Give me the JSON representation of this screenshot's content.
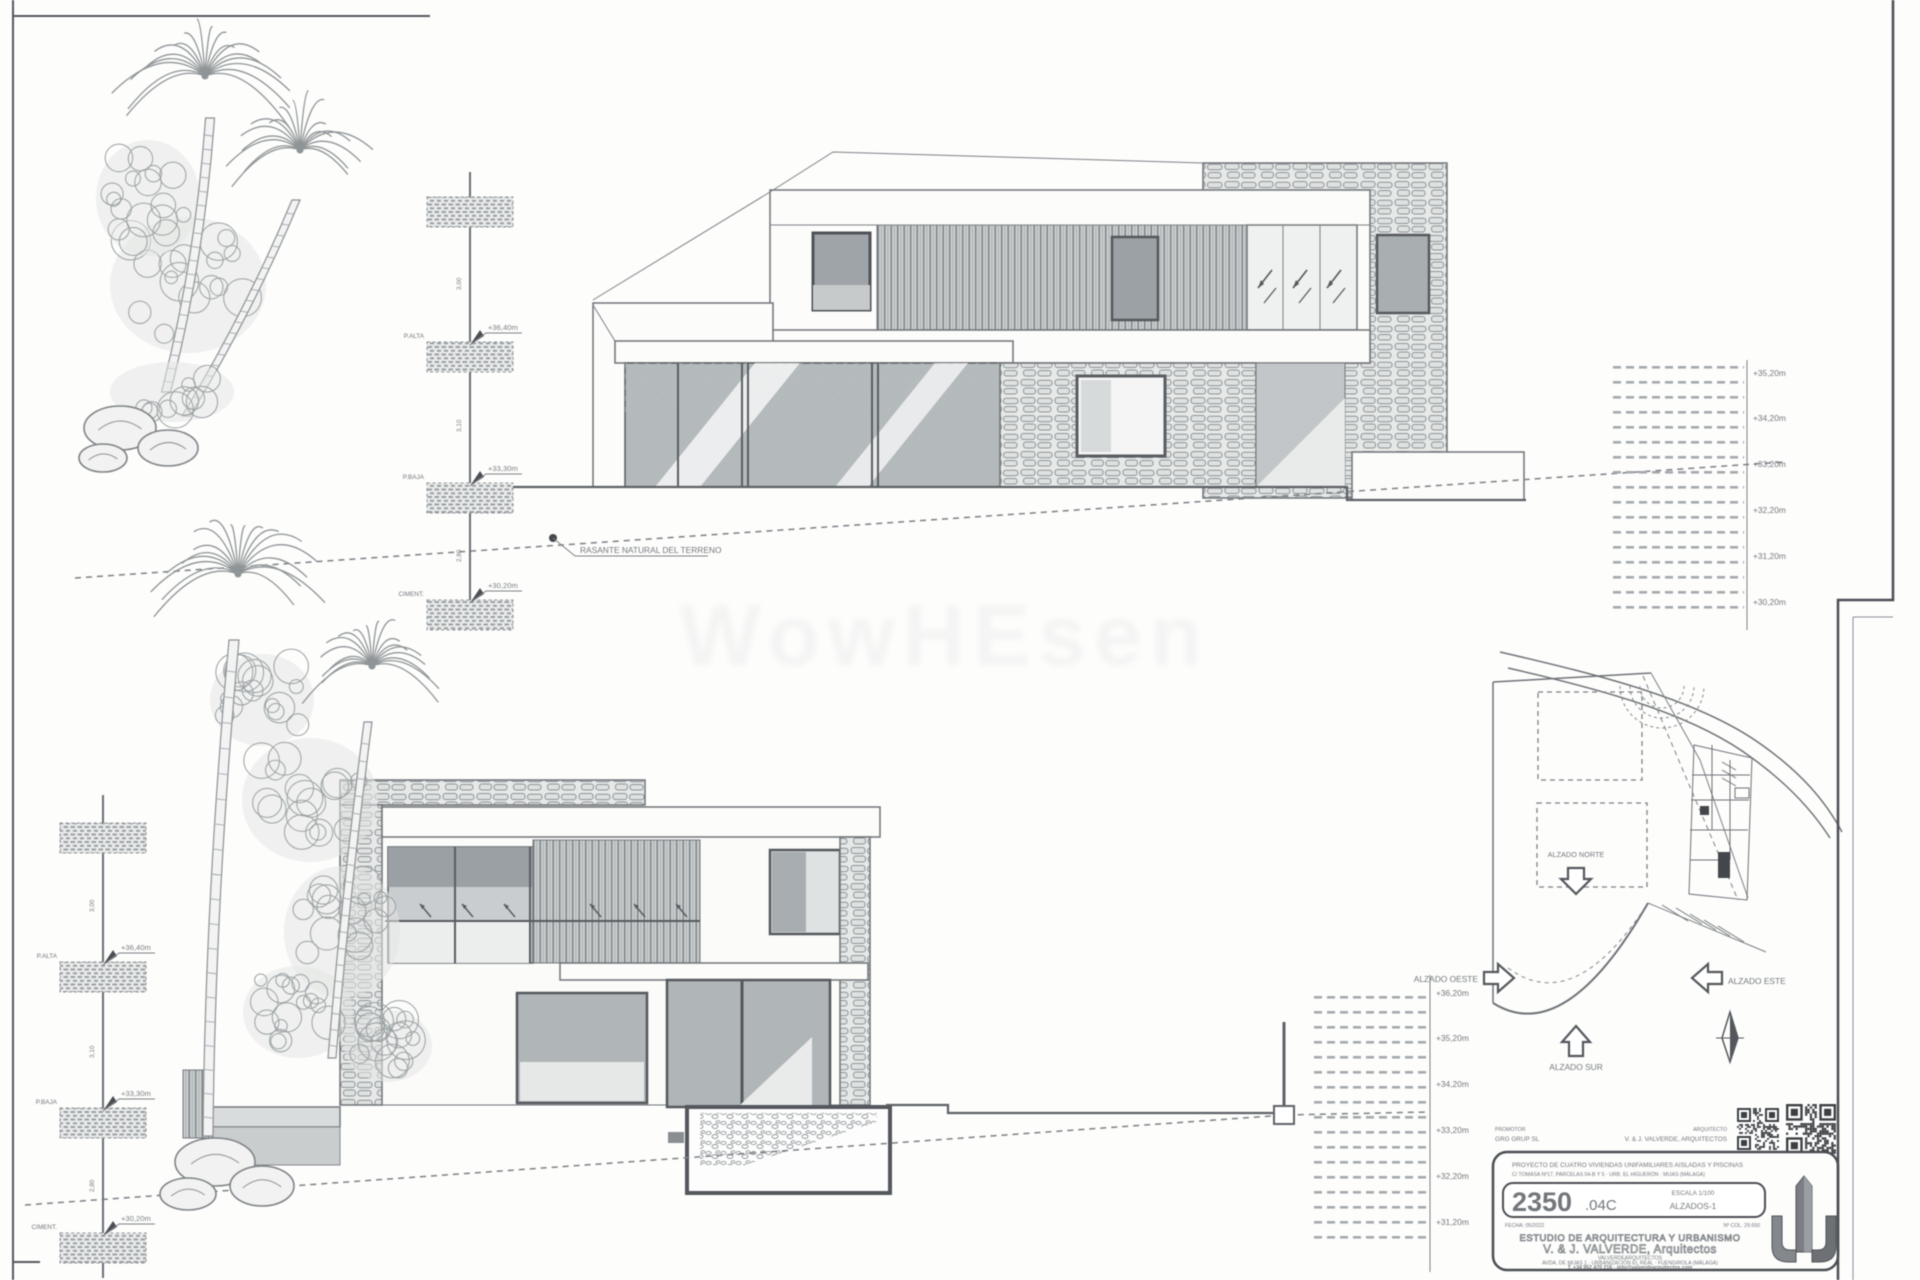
{
  "sheet": {
    "watermark": "WowHEsen"
  },
  "labels": {
    "terrain": "RASANTE NATURAL DEL TERRENO",
    "alzado_norte": "ALZADO NORTE",
    "alzado_sur": "ALZADO SUR",
    "alzado_oeste": "ALZADO OESTE",
    "alzado_este": "ALZADO ESTE"
  },
  "levels": {
    "alta": {
      "name": "P.ALTA",
      "elev": "+36,40m"
    },
    "baja": {
      "name": "P.BAJA",
      "elev": "+33,30m"
    },
    "cimentacion": {
      "name": "CIMENT.",
      "elev": "+30,20m"
    },
    "dims": [
      "3,00",
      "3,10",
      "2,80"
    ]
  },
  "ruler_top": [
    "+35,20m",
    "+34,20m",
    "+33,20m",
    "+32,20m",
    "+31,20m",
    "+30,20m"
  ],
  "ruler_bottom": [
    "+36,20m",
    "+35,20m",
    "+34,20m",
    "+33,20m",
    "+32,20m",
    "+31,20m"
  ],
  "title_block": {
    "promoter_label": "PROMOTOR",
    "promoter": "GRG GRUP SL",
    "architect_label": "ARQUITECTO",
    "architect": "V. & J. VALVERDE, ARQUITECTOS",
    "project_line1": "PROYECTO DE CUATRO VIVIENDAS UNIFAMILIARES AISLADAS Y PISCINAS",
    "project_line2": "C/ TOMASA Nº17, PARCELAS 04-B Y 5 · URB. EL HIGUERÓN · MIJAS (MÁLAGA)",
    "number_big": "2350",
    "number_suffix": ".04C",
    "scale_label": "ESCALA 1/100",
    "sheet_name": "ALZADOS-1",
    "date_left": "FECHA: 05/2022",
    "colegio_right": "Nº COL. 29.650",
    "studio_line1": "ESTUDIO DE ARQUITECTURA Y URBANISMO",
    "studio_line2": "V. & J. VALVERDE, Arquitectos",
    "studio_sub": "VALVERDEARQUITECTOS",
    "address_line": "AVDA. DE MIJAS 1 · URBANIZACIÓN EL REAL · FUENGIROLA (MÁLAGA)",
    "contact_line": "T. +34 952 470 216 · info@valverdearquitectos.com"
  }
}
